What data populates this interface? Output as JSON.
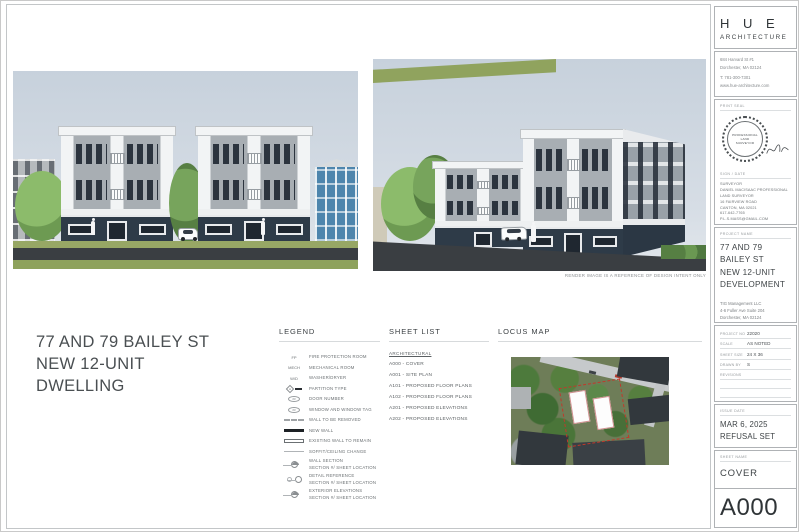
{
  "main": {
    "title": {
      "l1": "77 AND 79 BAILEY ST",
      "l2": "NEW 12-UNIT",
      "l3": "DWELLING"
    },
    "render_caption": "RENDER IMAGE IS A REFERENCE OF DESIGN INTENT ONLY",
    "legend": {
      "header": "LEGEND",
      "partition_letter": "A",
      "door_tag": "##",
      "window_tag": "##",
      "items": [
        {
          "sym": "FP",
          "label": "FIRE PROTECTION ROOM"
        },
        {
          "sym": "MECH",
          "label": "MECHANICAL ROOM"
        },
        {
          "sym": "W/D",
          "label": "WASHER/DRYER"
        },
        {
          "label": "PARTITION TYPE"
        },
        {
          "label": "DOOR NUMBER"
        },
        {
          "label": "WINDOW AND WINDOW TAG"
        },
        {
          "label": "WALL TO BE REMOVED"
        },
        {
          "label": "NEW WALL"
        },
        {
          "label": "EXISTING WALL TO REMAIN"
        },
        {
          "label": "SOFFIT/CEILING CHANGE"
        },
        {
          "label": "WALL SECTION",
          "sub": "SECTION #/ SHEET LOCATION"
        },
        {
          "label": "DETAIL REFERENCE",
          "sub": "SECTION #/ SHEET LOCATION"
        },
        {
          "label": "EXTERIOR ELEVATIONS",
          "sub": "SECTION #/ SHEET LOCATION"
        }
      ]
    },
    "sheet_list": {
      "header": "SHEET LIST",
      "discipline": "ARCHITECTURAL",
      "items": [
        "A000 - COVER",
        "A001 - SITE PLAN",
        "A101 - PROPOSED FLOOR PLANS",
        "A102 - PROPOSED FLOOR PLANS",
        "A201 - PROPOSED ELEVATIONS",
        "A202 - PROPOSED ELEVATIONS"
      ]
    },
    "locus": {
      "header": "LOCUS MAP"
    }
  },
  "titleblock": {
    "firm_name": "H U E",
    "firm_type": "ARCHITECTURE",
    "contact": {
      "address1": "684 Harvard St #1",
      "address2": "Dorchester, MA 02124",
      "phone": "T: 781-300-7301",
      "web": "www.hue-architecture.com"
    },
    "seal_label": "PRINT SEAL",
    "seal_text": {
      "l1": "PROFESSIONAL",
      "l2": "LAND",
      "l3": "SURVEYOR"
    },
    "sign_label": "SIGN / DATE",
    "surveyor": {
      "label": "SURVEYOR",
      "line1": "DANIEL MACISAAC PROFESSIONAL",
      "line2": "LAND SURVEYOR",
      "line3": "16 FAIRVIEW ROAD",
      "line4": "CANTON, MA 02021",
      "line5": "617-642-7765",
      "line6": "P.L.S.MASS@GMAIL.COM"
    },
    "project_label": "PROJECT NAME",
    "project": {
      "l1": "77 AND 79",
      "l2": "BAILEY ST",
      "l3": "NEW 12-UNIT",
      "l4": "DEVELOPMENT"
    },
    "client": {
      "l1": "TIG Management LLC",
      "l2": "4-6 Fuller Ave Suite 204",
      "l3": "Dorchester, MA 02124"
    },
    "info_rows": [
      {
        "label": "PROJECT NO",
        "value": "22020"
      },
      {
        "label": "SCALE",
        "value": "AS NOTED"
      },
      {
        "label": "SHEET SIZE",
        "value": "24 X 36"
      },
      {
        "label": "DRAWN BY",
        "value": "S"
      },
      {
        "label": "REVISIONS",
        "value": ""
      }
    ],
    "issue": {
      "label": "ISSUE DATE",
      "date": "MAR 6, 2025",
      "set": "REFUSAL SET"
    },
    "sheet": {
      "name_label": "SHEET NAME",
      "name": "COVER",
      "number": "A000"
    }
  }
}
